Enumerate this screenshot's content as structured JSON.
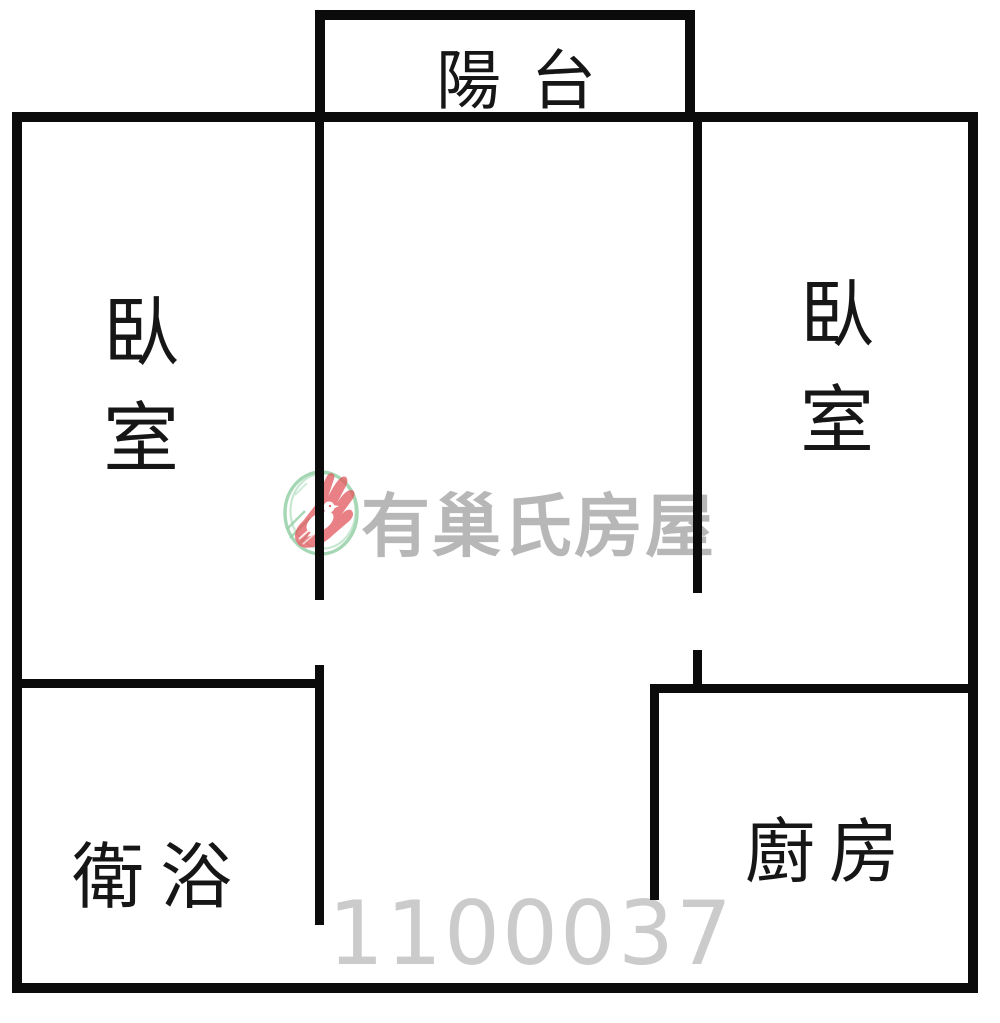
{
  "page": {
    "background_color": "#ffffff",
    "wall_color": "#0b0b0b",
    "label_color": "#161616"
  },
  "rooms": {
    "balcony": {
      "label": "陽台"
    },
    "bedroom_left": {
      "label": "臥室",
      "chars": [
        "臥",
        "室"
      ]
    },
    "bedroom_right": {
      "label": "臥室",
      "chars": [
        "臥",
        "室"
      ]
    },
    "bathroom": {
      "label": "衛浴"
    },
    "kitchen": {
      "label": "廚房"
    }
  },
  "watermark": {
    "brand": "有巢氏房屋",
    "photo_id": "1100037",
    "brand_color": "#b7b7b7",
    "photo_id_color": "#cbcbcb",
    "logo": {
      "name": "u-trust-realty-logo",
      "circle_green": "#7cc492",
      "hand_red": "#e25a5f",
      "bird_white": "#ffffff"
    }
  }
}
